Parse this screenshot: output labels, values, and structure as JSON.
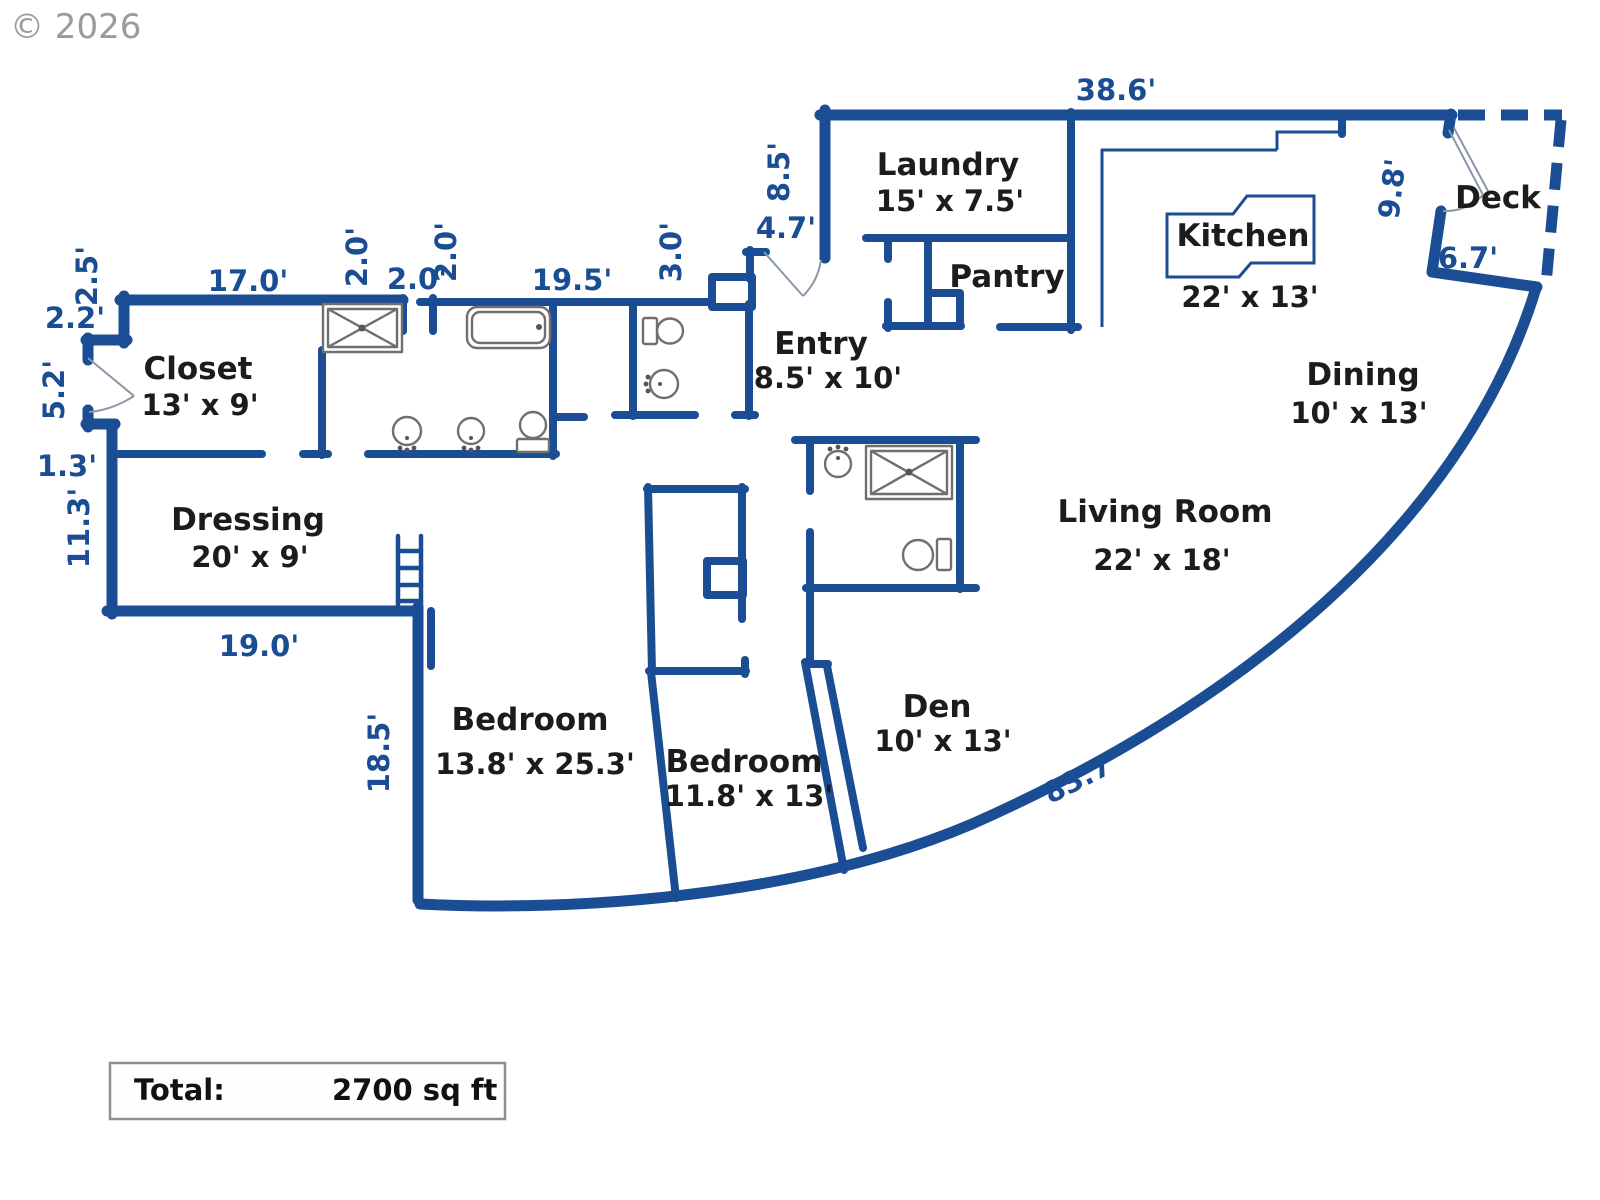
{
  "meta": {
    "copyright": "© 2026"
  },
  "total": {
    "label": "Total:",
    "value": "2700 sq ft"
  },
  "rooms": {
    "laundry": {
      "name": "Laundry",
      "dims": "15' x 7.5'"
    },
    "pantry": {
      "name": "Pantry"
    },
    "kitchen": {
      "name": "Kitchen",
      "dims": "22' x 13'"
    },
    "deck": {
      "name": "Deck"
    },
    "dining": {
      "name": "Dining",
      "dims": "10' x 13'"
    },
    "living": {
      "name": "Living Room",
      "dims": "22' x 18'"
    },
    "entry": {
      "name": "Entry",
      "dims": "8.5' x 10'"
    },
    "closet": {
      "name": "Closet",
      "dims": "13' x 9'"
    },
    "dressing": {
      "name": "Dressing",
      "dims": "20' x 9'"
    },
    "bedroom1": {
      "name": "Bedroom",
      "dims": "13.8' x 25.3'"
    },
    "bedroom2": {
      "name": "Bedroom",
      "dims": "11.8' x 13'"
    },
    "den": {
      "name": "Den",
      "dims": "10' x 13'"
    }
  },
  "dims": {
    "top": "38.6'",
    "laundry_side": "8.5'",
    "entry_top": "4.7'",
    "powder_side": "3.0'",
    "deck_side": "9.8'",
    "deck_bottom": "6.7'",
    "closet_top": "17.0'",
    "jog_a": "2.0'",
    "jog_b": "2.0'",
    "jog_c": "2.0'",
    "bath_top": "19.5'",
    "left_a": "2.2'",
    "left_b": "2.5'",
    "left_c": "5.2'",
    "left_d": "1.3'",
    "left_e": "11.3'",
    "dressing_bottom": "19.0'",
    "bedroom_side": "18.5'",
    "curve": "83.7'"
  },
  "colors": {
    "wall": "#1b4d94",
    "dim_text": "#1b4d94",
    "room_text": "#1c1c1c",
    "fixture": "#6f6f6f",
    "copyright": "#9b9b9b"
  }
}
